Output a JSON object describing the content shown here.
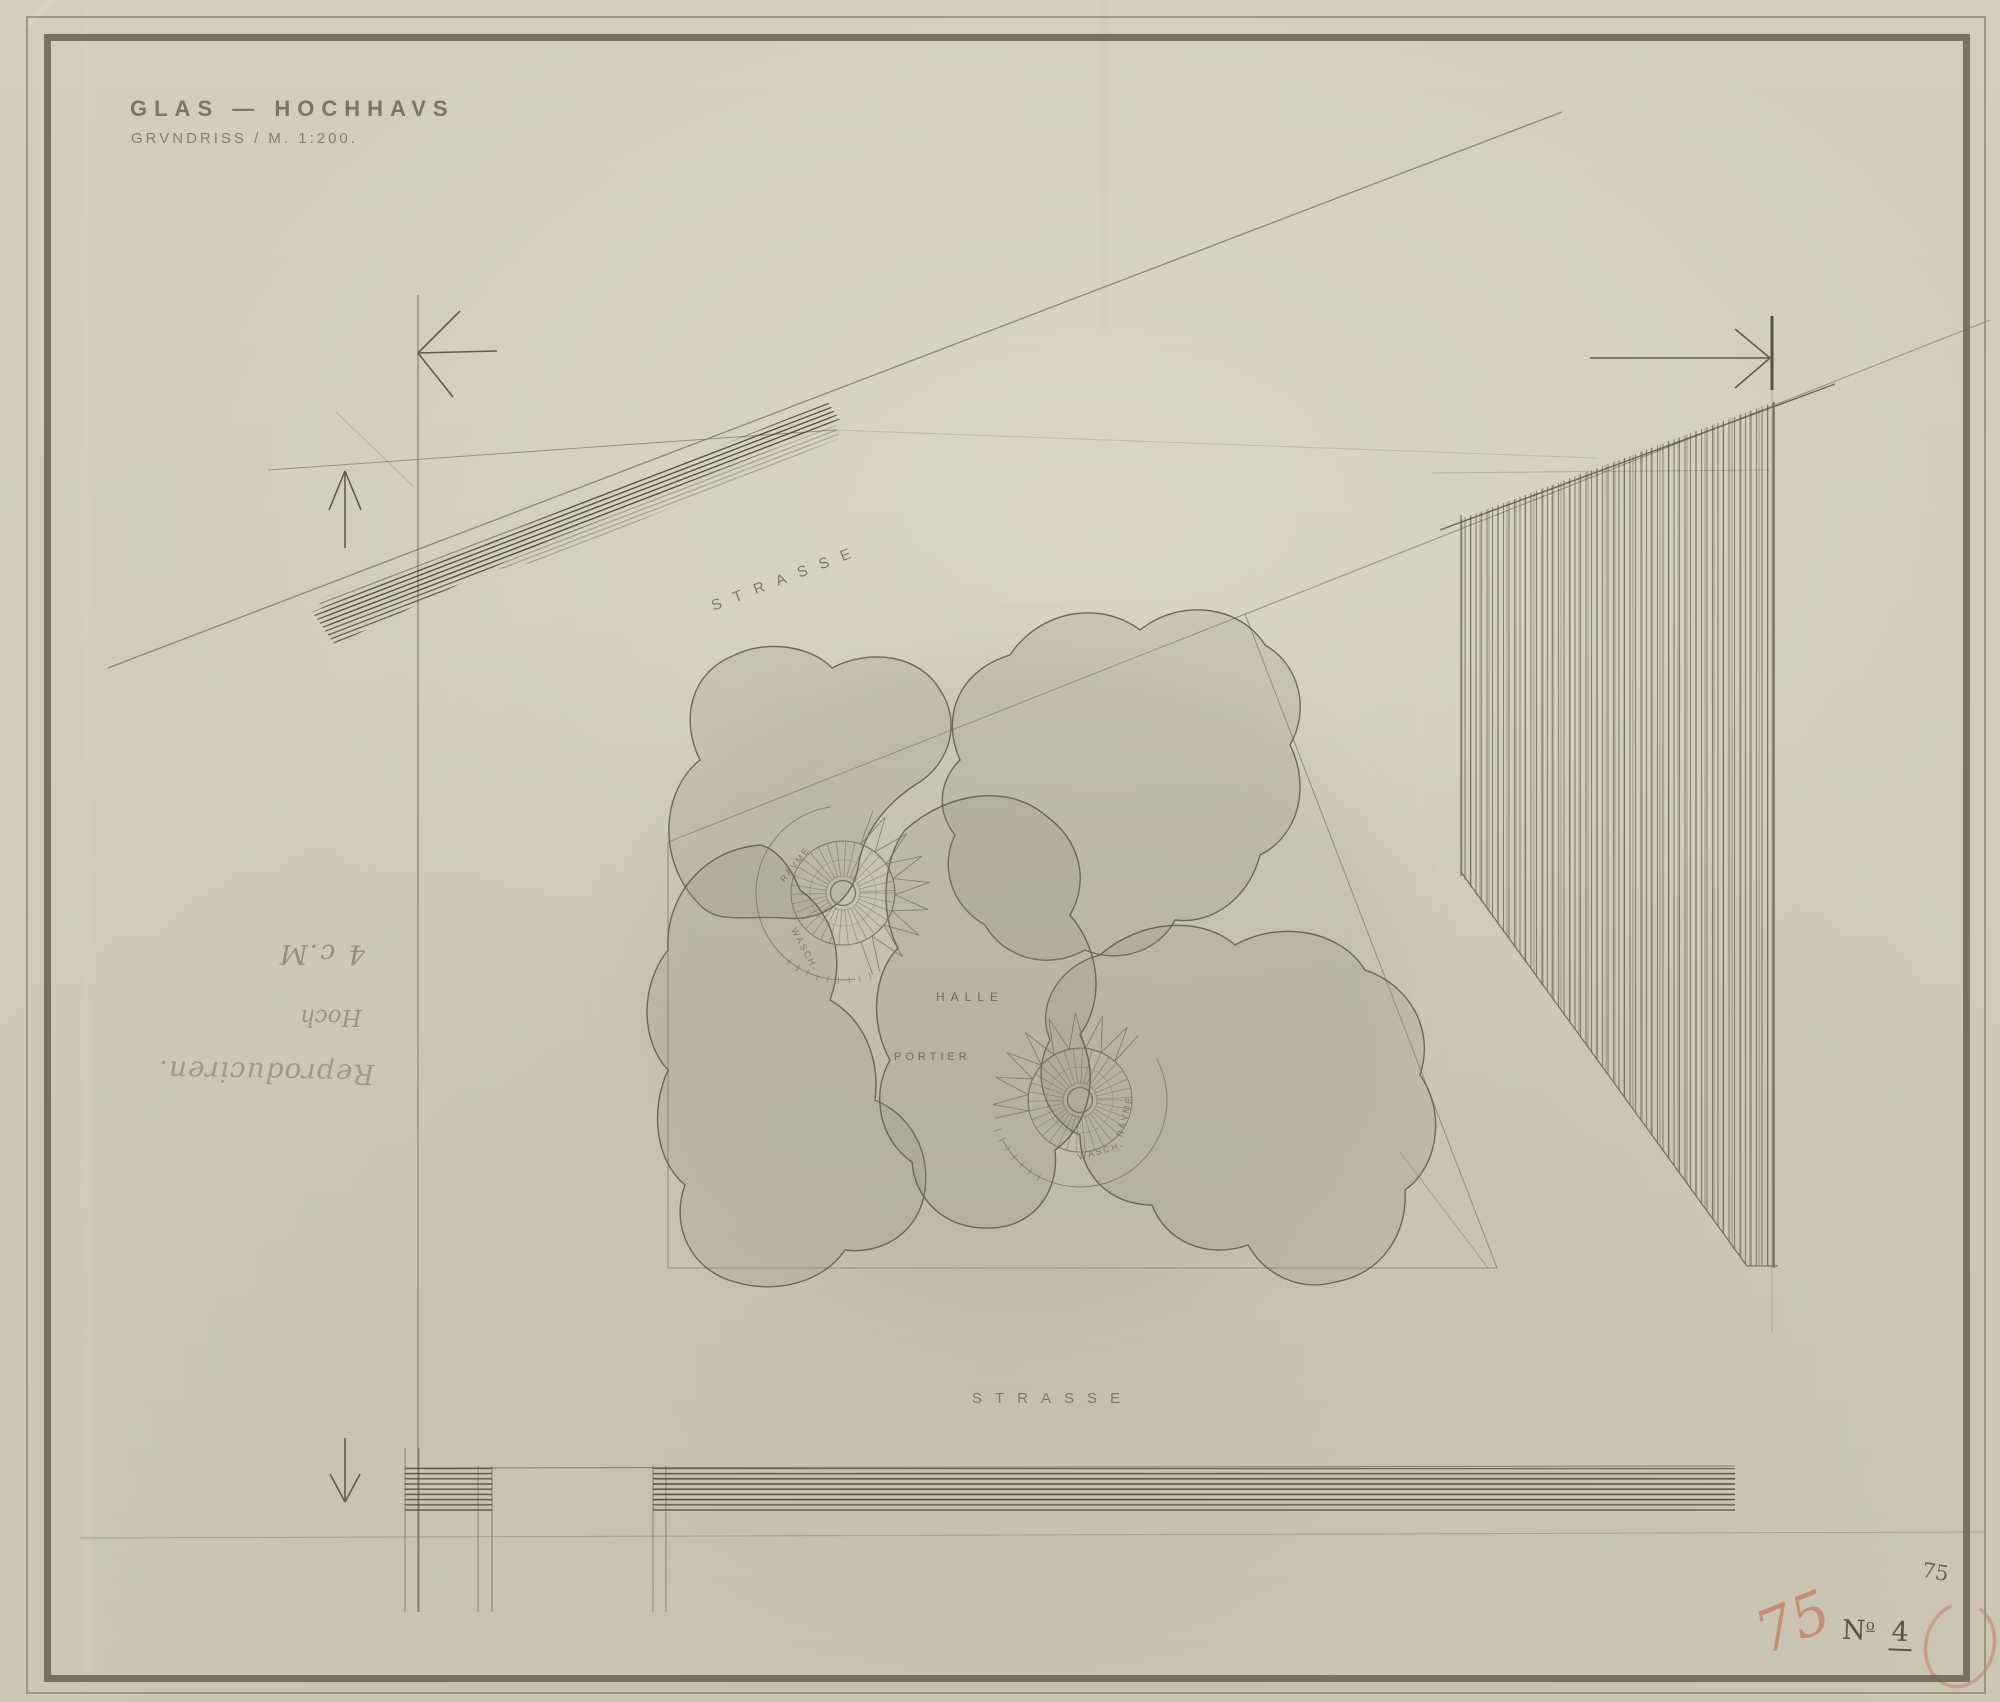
{
  "sheet": {
    "title": "GLAS — HOCHHAVS",
    "subtitle": "GRVNDRISS / M. 1:200."
  },
  "streets": {
    "top_label": "STRASSE",
    "bottom_label": "STRASSE"
  },
  "plan": {
    "hall_label": "HALLE",
    "porter_label": "PORTIER",
    "core1": {
      "upper_label": "RÄVME",
      "lower_label": "WASCH-"
    },
    "core2": {
      "upper_label": "RÄVME",
      "lower_label": "WASCH-"
    }
  },
  "handwritten_notes": {
    "size_note": "4 c.M",
    "height_note": "Hoch",
    "reproduction_note": "Reproduciren."
  },
  "corner_marks": {
    "pencil_number": "75",
    "plate_prefix": "N",
    "plate_sup": "o",
    "plate_digit": "4",
    "red_number": "75"
  },
  "colors": {
    "paper": "#d0cbba",
    "pencil_line": "#76705d",
    "graphite_hatch": "#4c4a3a",
    "red_crayon": "#c4705a",
    "border_band": "#6c6550"
  }
}
